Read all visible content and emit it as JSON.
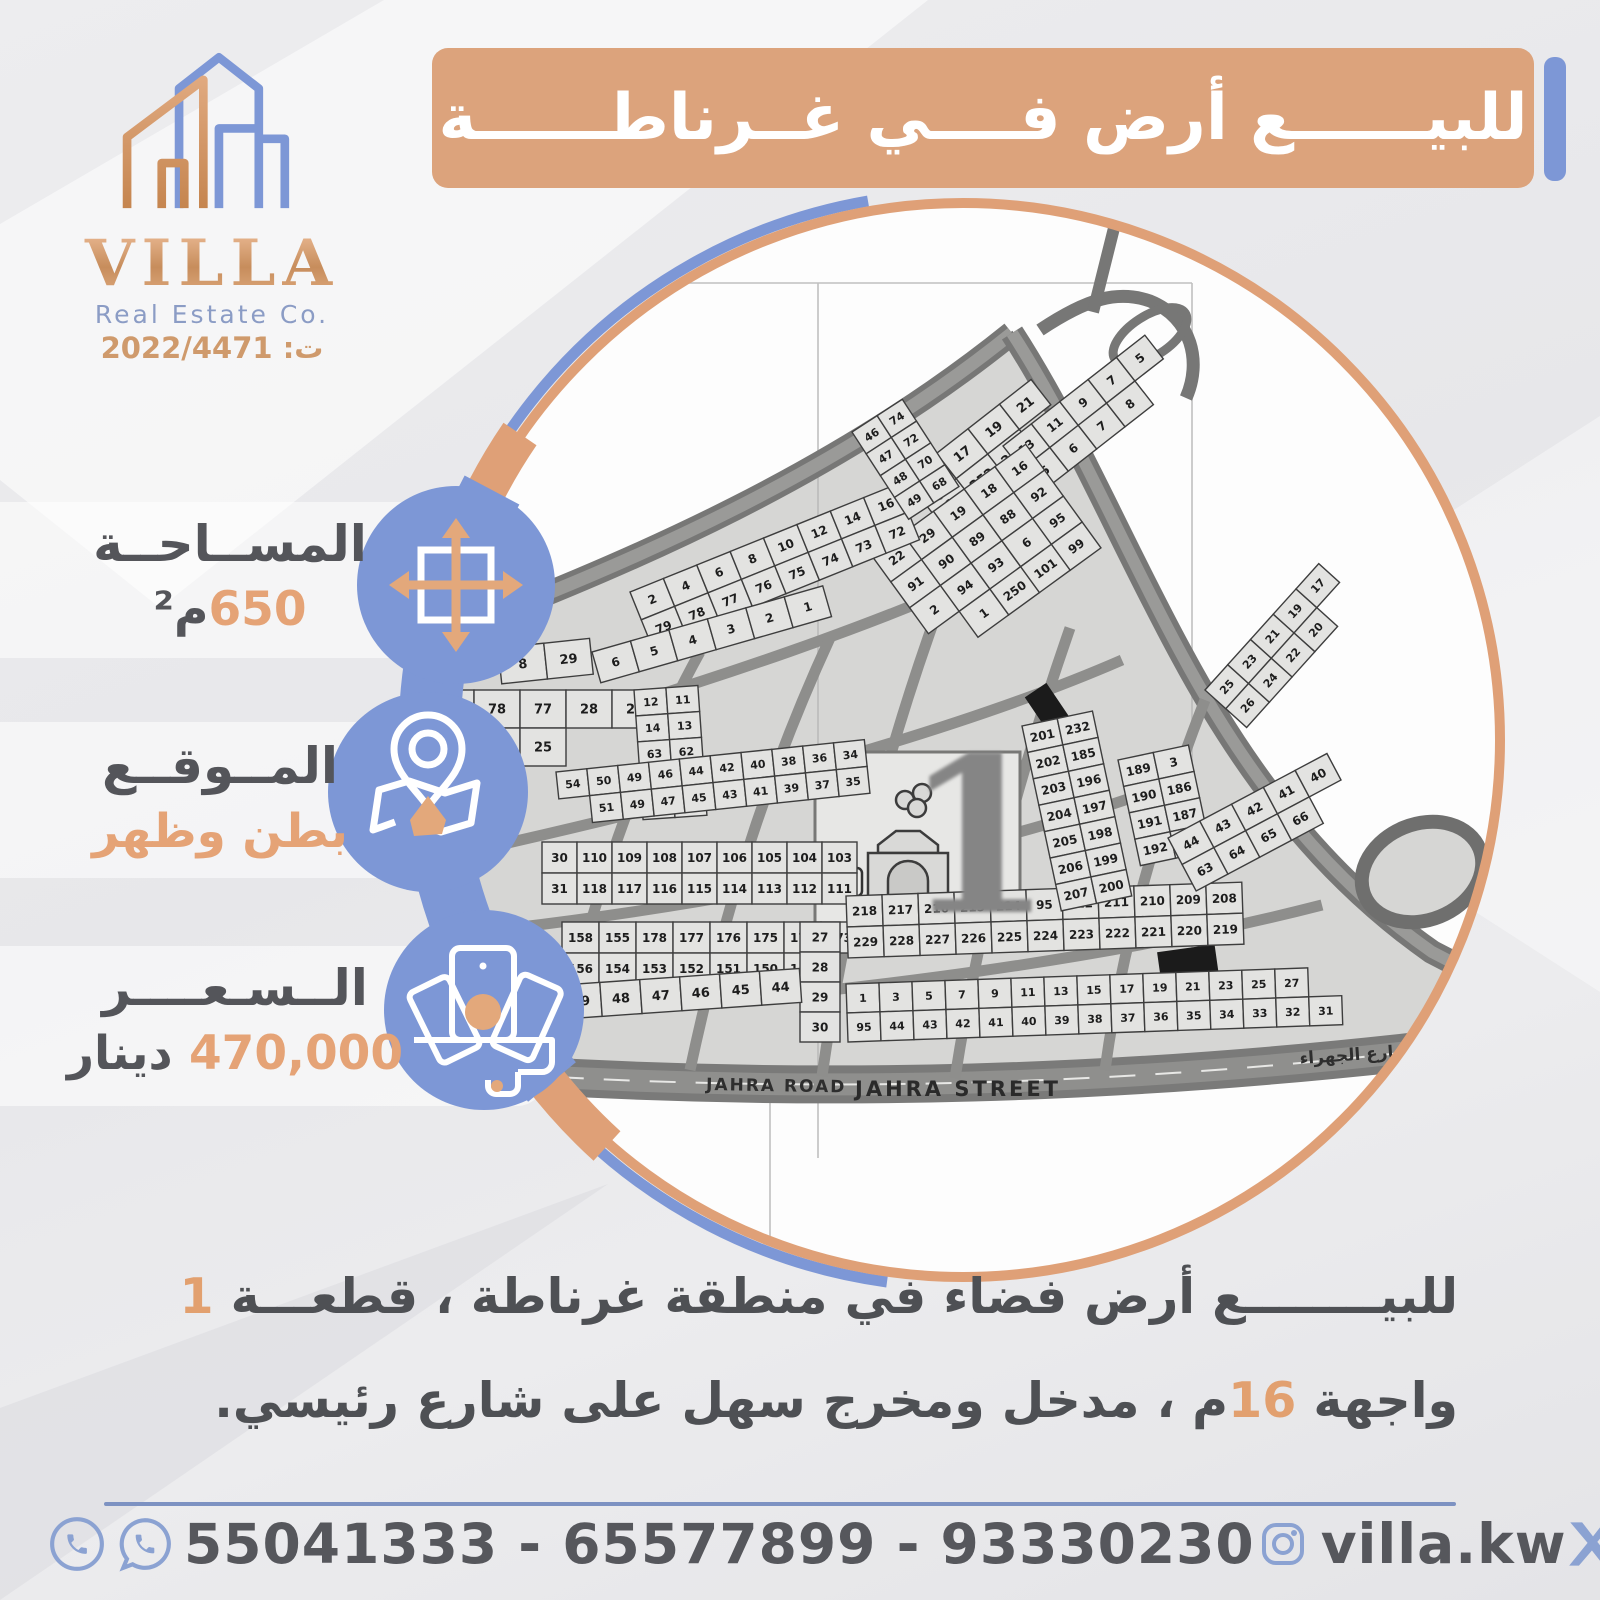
{
  "logo": {
    "name": "VILLA",
    "subtitle": "Real Estate Co.",
    "registration": "ت: 2022/4471"
  },
  "banner": {
    "title": "للبيــــــع أرض فــــي غــرناطــــــة"
  },
  "info": {
    "area": {
      "label": "المســاحــة",
      "value": "650",
      "unit": "م²"
    },
    "location": {
      "label": "المــوقــع",
      "value": "بطن وظهر"
    },
    "price": {
      "label": "الــسـعــــر",
      "value": "470,000",
      "unit": "دينار"
    }
  },
  "description": {
    "line1_text": "للبيــــــــع أرض فضاء في منطقة غرناطة ، قطعـــة ",
    "line1_highlight": "1",
    "line2_pre": "واجهة ",
    "line2_highlight": "16",
    "line2_post": "م ، مدخل ومخرج سهل على شارع رئيسي."
  },
  "contact": {
    "phones": "55041333 - 65577899 - 93330230",
    "instagram_handle": "villa.kw",
    "social_handle": "villa_kw"
  },
  "map": {
    "big_plot_number": "1",
    "parking_label": "P",
    "road_label_1": "JAHRA ROAD",
    "road_label_2": "JAHRA STREET",
    "road_label_ar": "شارع الجهراء",
    "blocks": [
      {
        "rows": [
          [
            "15",
            "17",
            "19",
            "21"
          ],
          [
            "1",
            "252",
            "253",
            ""
          ]
        ]
      },
      {
        "rows": [
          [
            "13",
            "11",
            "9",
            "7",
            "5"
          ],
          [
            "5",
            "6",
            "7",
            "8",
            ""
          ]
        ]
      },
      {
        "rows": [
          [
            "22",
            "29",
            "19",
            "18",
            "16"
          ],
          [
            "91",
            "90",
            "89",
            "88",
            "92"
          ],
          [
            "2",
            "94",
            "93",
            "6",
            "95"
          ],
          [
            "",
            "1",
            "250",
            "101",
            "99"
          ]
        ]
      },
      {
        "rows": [
          [
            "2",
            "4",
            "6",
            "8",
            "10",
            "12",
            "14",
            "16",
            "18"
          ],
          [
            "79",
            "78",
            "77",
            "76",
            "75",
            "74",
            "73",
            "72",
            ""
          ]
        ]
      },
      {
        "rows": [
          [
            "8",
            "29"
          ]
        ]
      },
      {
        "rows": [
          [
            "6",
            "5",
            "4",
            "3",
            "2",
            "1"
          ]
        ]
      },
      {
        "rows": [
          [
            "79",
            "78",
            "77",
            "28",
            "27"
          ],
          [
            "82",
            "26",
            "25",
            "",
            ""
          ]
        ]
      },
      {
        "rows": [
          [
            "12",
            "11"
          ],
          [
            "14",
            "13"
          ],
          [
            "63",
            "62"
          ],
          [
            "65",
            "64"
          ],
          [
            "67",
            "68"
          ]
        ]
      },
      {
        "rows": [
          [
            "54",
            "50",
            "49",
            "46",
            "44",
            "42",
            "40",
            "38",
            "36",
            "34"
          ],
          [
            "",
            "51",
            "49",
            "47",
            "45",
            "43",
            "41",
            "39",
            "37",
            "35"
          ]
        ]
      },
      {
        "rows": [
          [
            "30",
            "110",
            "109",
            "108",
            "107",
            "106",
            "105",
            "104",
            "103"
          ],
          [
            "31",
            "118",
            "117",
            "116",
            "115",
            "114",
            "113",
            "112",
            "111"
          ]
        ]
      },
      {
        "rows": [
          [
            "158",
            "155",
            "178",
            "177",
            "176",
            "175",
            "174",
            "173"
          ],
          [
            "156",
            "154",
            "153",
            "152",
            "151",
            "150",
            "149",
            ""
          ]
        ]
      },
      {
        "rows": [
          [
            "27"
          ],
          [
            "28"
          ],
          [
            "29"
          ],
          [
            "30"
          ]
        ]
      },
      {
        "rows": [
          [
            "218",
            "217",
            "216",
            "215",
            "214",
            "95",
            "212",
            "211",
            "210",
            "209",
            "208"
          ],
          [
            "229",
            "228",
            "227",
            "226",
            "225",
            "224",
            "223",
            "222",
            "221",
            "220",
            "219"
          ]
        ]
      },
      {
        "rows": [
          [
            "1",
            "3",
            "5",
            "7",
            "9",
            "11",
            "13",
            "15",
            "17",
            "19",
            "21",
            "23",
            "25",
            "27",
            ""
          ],
          [
            "95",
            "44",
            "43",
            "42",
            "41",
            "40",
            "39",
            "38",
            "37",
            "36",
            "35",
            "34",
            "33",
            "32",
            "31"
          ]
        ]
      },
      {
        "rows": [
          [
            "50",
            "49",
            "48",
            "47",
            "46",
            "45",
            "44"
          ]
        ]
      },
      {
        "rows": [
          [
            "201",
            "232"
          ],
          [
            "202",
            "185"
          ],
          [
            "203",
            "196"
          ],
          [
            "204",
            "197"
          ],
          [
            "205",
            "198"
          ],
          [
            "206",
            "199"
          ],
          [
            "207",
            "200"
          ]
        ]
      },
      {
        "rows": [
          [
            "189",
            "3"
          ],
          [
            "190",
            "186"
          ],
          [
            "191",
            "187"
          ],
          [
            "192",
            "188"
          ]
        ]
      },
      {
        "rows": [
          [
            "46",
            "74"
          ],
          [
            "47",
            "72"
          ],
          [
            "48",
            "70"
          ],
          [
            "49",
            "68"
          ]
        ]
      },
      {
        "rows": [
          [
            "44",
            "43",
            "42",
            "41",
            "40"
          ],
          [
            "63",
            "64",
            "65",
            "66",
            ""
          ]
        ]
      },
      {
        "rows": [
          [
            "25",
            "23",
            "21",
            "19",
            "17"
          ],
          [
            "26",
            "24",
            "22",
            "20",
            ""
          ]
        ]
      }
    ]
  },
  "colors": {
    "blue": "#7d97d6",
    "blue_soft": "#8ba2d2",
    "orange": "#dca37c",
    "orange_text": "#e5a376",
    "copper": "#cf9a6c",
    "dark_text": "#54555a",
    "divider": "#7d92c2"
  }
}
